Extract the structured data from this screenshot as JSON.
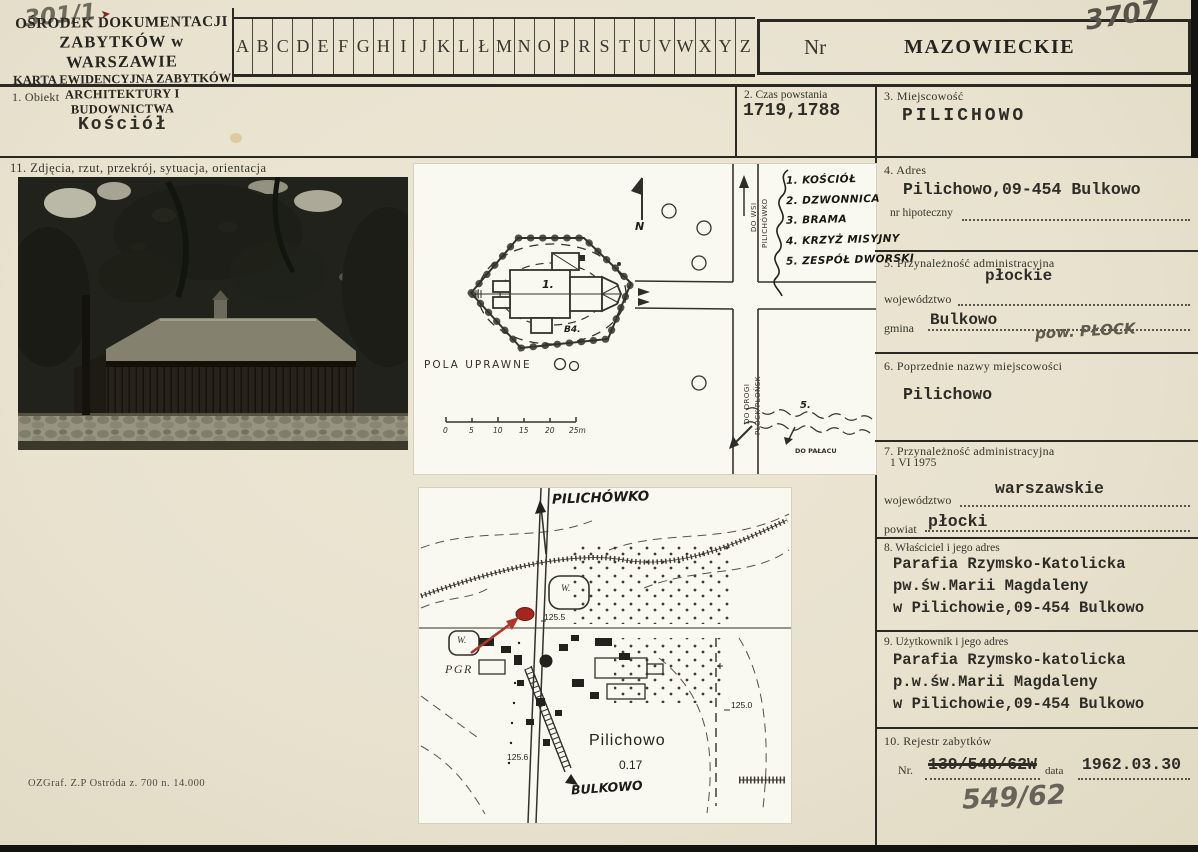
{
  "meta": {
    "corner_note": "301/1",
    "corner_mark": "➤",
    "print_info": "OZGraf. Z.P  Ostróda z. 700 n. 14.000"
  },
  "colors": {
    "paper": "#eae4d1",
    "ink": "#2b2923",
    "red_marker": "#a3271c",
    "pencil": "#6e6a5c"
  },
  "header": {
    "org_line1": "OŚRODEK DOKUMENTACJI",
    "org_line2": "ZABYTKÓW w WARSZAWIE",
    "org_line3": "KARTA EWIDENCYJNA ZABYTKÓW",
    "org_line4": "ARCHITEKTURY I BUDOWNICTWA",
    "letters": [
      "A",
      "B",
      "C",
      "D",
      "E",
      "F",
      "G",
      "H",
      "I",
      "J",
      "K",
      "L",
      "Ł",
      "M",
      "N",
      "O",
      "P",
      "R",
      "S",
      "T",
      "U",
      "V",
      "W",
      "X",
      "Y",
      "Z"
    ],
    "nr_label": "Nr",
    "region_stamp": "MAZOWIECKIE",
    "card_number": "3707"
  },
  "fields": {
    "f1": {
      "label": "1. Obiekt",
      "value": "Kościół"
    },
    "f2": {
      "label": "2. Czas powstania",
      "value": "1719,1788"
    },
    "f3": {
      "label": "3. Miejscowość",
      "value": "PILICHOWO"
    },
    "f4": {
      "label": "4. Adres",
      "value": "Pilichowo,09-454 Bulkowo",
      "sub_label": "nr hipoteczny"
    },
    "f5": {
      "label": "5. Przynależność administracyjna",
      "wojewodztwo_label": "województwo",
      "wojewodztwo": "płockie",
      "gmina_label": "gmina",
      "gmina": "Bulkowo",
      "handwritten_note": "pow. PŁOCK"
    },
    "f6": {
      "label": "6. Poprzednie nazwy miejscowości",
      "value": "Pilichowo"
    },
    "f7": {
      "label": "7. Przynależność administracyjna",
      "date_line": "1 VI 1975",
      "wojewodztwo_label": "województwo",
      "wojewodztwo": "warszawskie",
      "powiat_label": "powiat",
      "powiat": "płocki"
    },
    "f8": {
      "label": "8. Właściciel i jego adres",
      "line1": "Parafia Rzymsko-Katolicka",
      "line2": "pw.św.Marii Magdaleny",
      "line3": "w Pilichowie,09-454 Bulkowo"
    },
    "f9": {
      "label": "9. Użytkownik i jego adres",
      "line1": "Parafia Rzymsko-katolicka",
      "line2": "p.w.św.Marii Magdaleny",
      "line3": "w Pilichowie,09-454 Bulkowo"
    },
    "f10": {
      "label": "10. Rejestr zabytków",
      "nr_label": "Nr.",
      "nr_crossed_out": "139/549/62W",
      "data_label": "data",
      "data_value": "1962.03.30",
      "handwritten_number": "549/62"
    },
    "f11": {
      "label": "11. Zdjęcia, rzut, przekrój, sytuacja, orientacja"
    }
  },
  "site_plan": {
    "church_number": "1.",
    "note_b4": "B4.",
    "fields_label": "POLA UPRAWNE",
    "north_letter": "N",
    "road_up_line1": "DO WSI",
    "road_up_line2": "PILICHÓWKO",
    "road_down_line1": "DO DROGI",
    "road_down_line2": "PŁOCK-PŁOŃSK",
    "palace_label": "DO PAŁACU",
    "manor_ref": "5.",
    "scale_ticks": [
      "0",
      "5",
      "10",
      "15",
      "20",
      "25m"
    ],
    "legend": [
      "1. KOŚCIÓŁ",
      "2. DZWONNICA",
      "3. BRAMA",
      "4. KRZYŻ MISYJNY",
      "5. ZESPÓŁ DWORSKI"
    ]
  },
  "map": {
    "village_top": "PILICHÓWKO",
    "pgr": "PGR",
    "pond_label": "W.",
    "pond_label2": "W.",
    "elevation_center": "125.5",
    "elevation_right": "125.0",
    "elevation_bottom": "125.6",
    "town_name": "Pilichowo",
    "town_area": "0.17",
    "village_bottom": "BULKOWO"
  }
}
